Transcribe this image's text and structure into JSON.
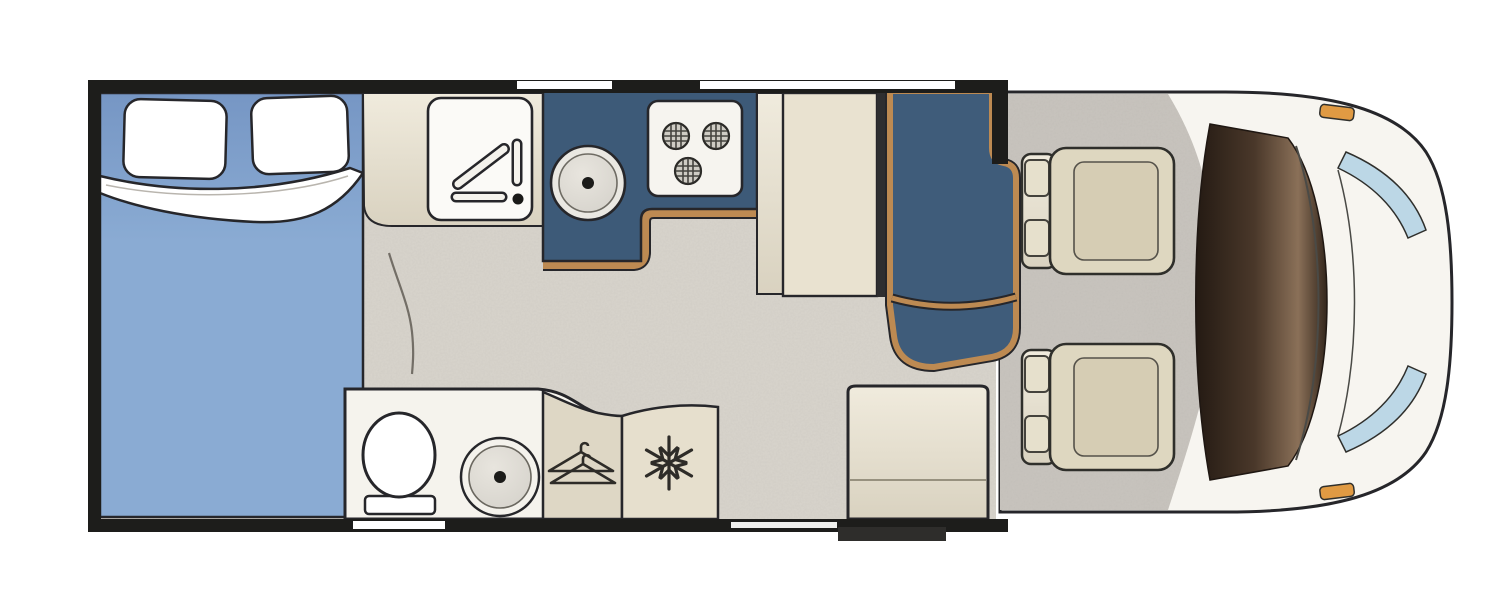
{
  "title": "Motorhome floor plan (top view)",
  "colors": {
    "outline": "#26262a",
    "wall": "#1d1d1b",
    "floor": "#d9d5cd",
    "carpet": "#c9c5bf",
    "window_white": "#ffffff",
    "door_strip": "#f0f0ee",
    "bed_blue": "#8aabd3",
    "bed_blue_dark": "#7696c4",
    "pillow_white": "#ffffff",
    "sheet_white": "#ffffff",
    "kitchen_blue": "#3d5a78",
    "bench_blue": "#3f5c7a",
    "wood_trim": "#bd8a52",
    "cream_light": "#f0ebdd",
    "cream_dark": "#d9d2c0",
    "table_cream": "#e9e2d0",
    "appliance_white": "#fbfaf7",
    "hob_white": "#f6f4ef",
    "burner_gray": "#cfccc4",
    "bath_floor": "#f5f3ed",
    "toilet_white": "#ffffff",
    "basin_gray": "#d5d2cb",
    "wardrobe_cream": "#ded7c5",
    "fridge_cream": "#e6dfcd",
    "seat_cream": "#ded7c0",
    "seat_inner": "#d6cdb4",
    "cab_body": "#f7f5f0",
    "dash_brown_dark": "#241a13",
    "dash_brown_light": "#8a7058",
    "glass_blue": "#bcd7e6",
    "indicator_orange": "#e09a43",
    "step_dark": "#2e2d2b"
  },
  "areas": {
    "bedroom": {
      "label": "Rear bedroom",
      "fixtures": [
        "double-bed",
        "pillow-left",
        "pillow-right",
        "duvet-fold"
      ]
    },
    "kitchen": {
      "label": "Kitchen",
      "fixtures": [
        "worktop",
        "drainer-unit",
        "round-sink",
        "hob-3-burner"
      ],
      "burner_count": 3
    },
    "bathroom": {
      "label": "Washroom",
      "fixtures": [
        "toilet",
        "shower-basin"
      ]
    },
    "wardrobe": {
      "label": "Wardrobe",
      "icon": "hanger-icon"
    },
    "fridge": {
      "label": "Fridge",
      "icon": "snowflake-icon"
    },
    "dinette": {
      "label": "Dinette",
      "fixtures": [
        "side-bench",
        "table",
        "lounge-seat"
      ]
    },
    "entrance": {
      "label": "Entrance",
      "fixtures": [
        "step-cabinet",
        "entry-step"
      ]
    },
    "cab": {
      "label": "Driving cab",
      "fixtures": [
        "driver-seat",
        "passenger-seat",
        "dashboard",
        "windscreen"
      ],
      "seat_count": 2
    }
  }
}
